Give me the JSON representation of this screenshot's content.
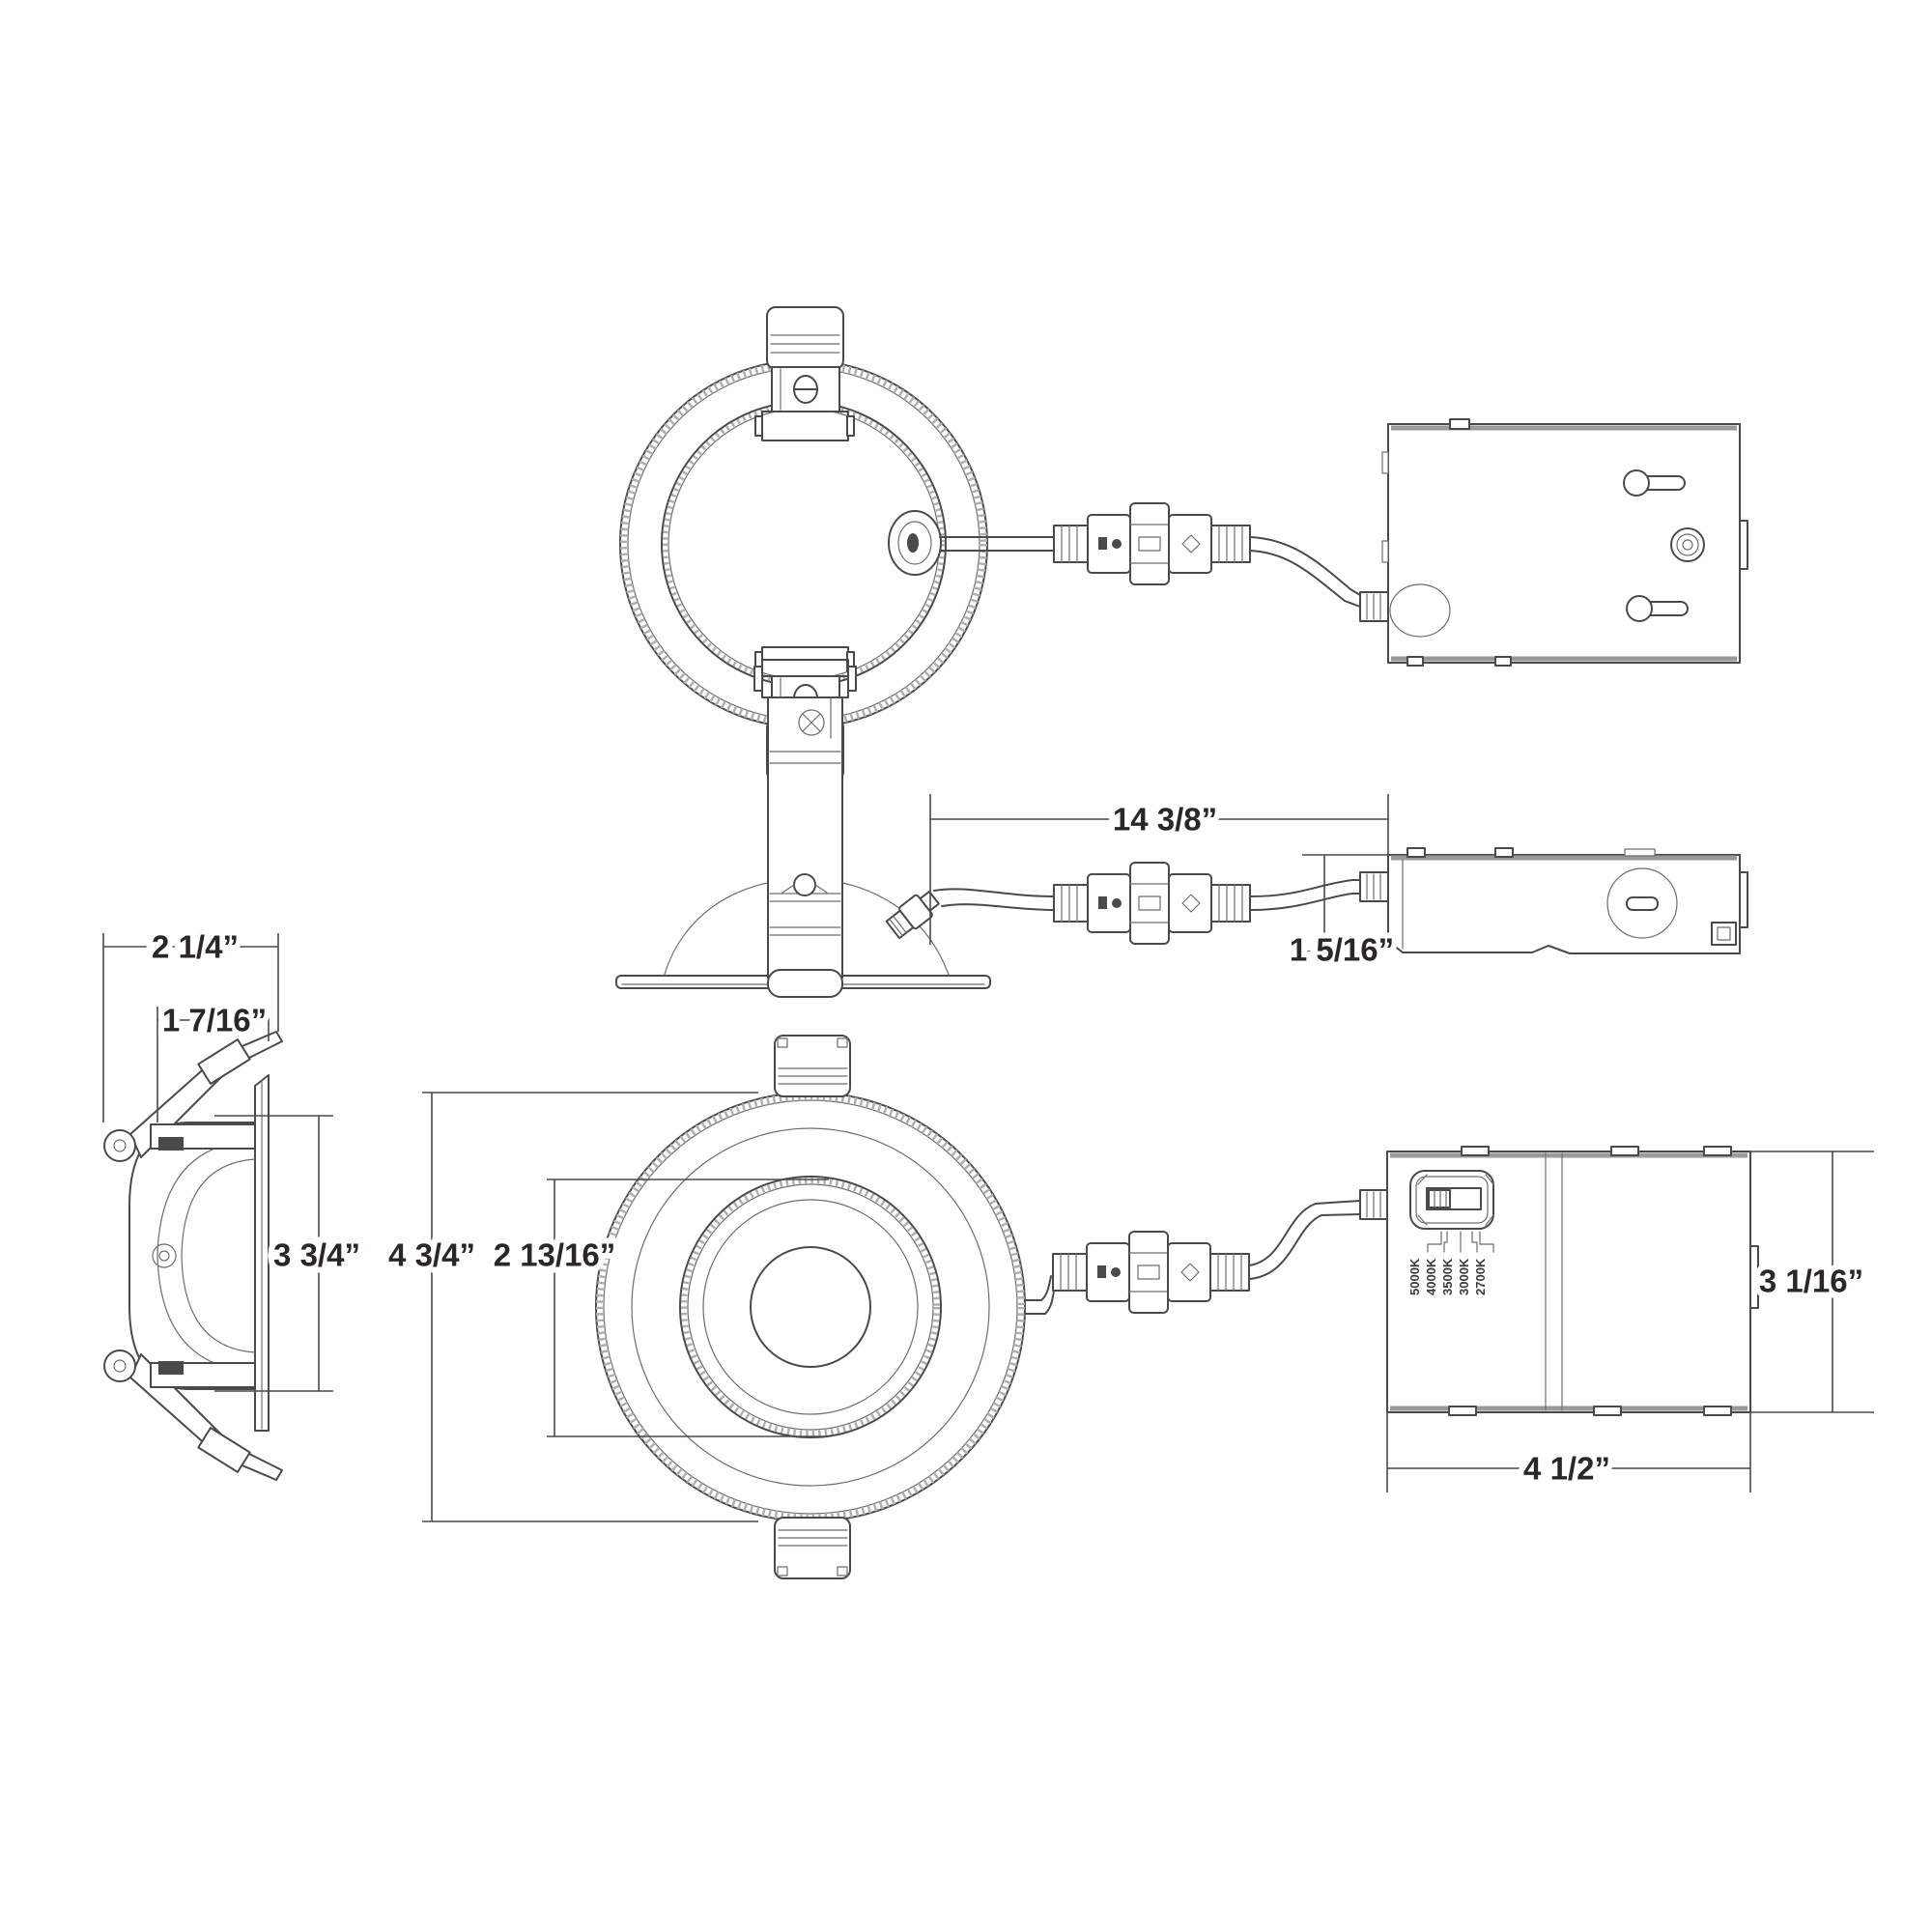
{
  "canvas": {
    "background": "#ffffff",
    "line_color": "#4a4a4a",
    "light_line_color": "#9a9a9a",
    "text_color": "#2b2727"
  },
  "dimensions": {
    "profile_overall_width": "2 1/4”",
    "profile_recess_width": "1 7/16”",
    "profile_housing_height": "3 3/4”",
    "front_trim_diameter": "4 3/4”",
    "front_aperture_diameter": "2 13/16”",
    "cable_length": "14 3/8”",
    "junction_box_side_height": "1 5/16”",
    "junction_box_front_height": "3 1/16”",
    "junction_box_front_width": "4 1/2”"
  },
  "cct_switch": {
    "labels": [
      "5000K",
      "4000K",
      "3500K",
      "3000K",
      "2700K"
    ]
  }
}
